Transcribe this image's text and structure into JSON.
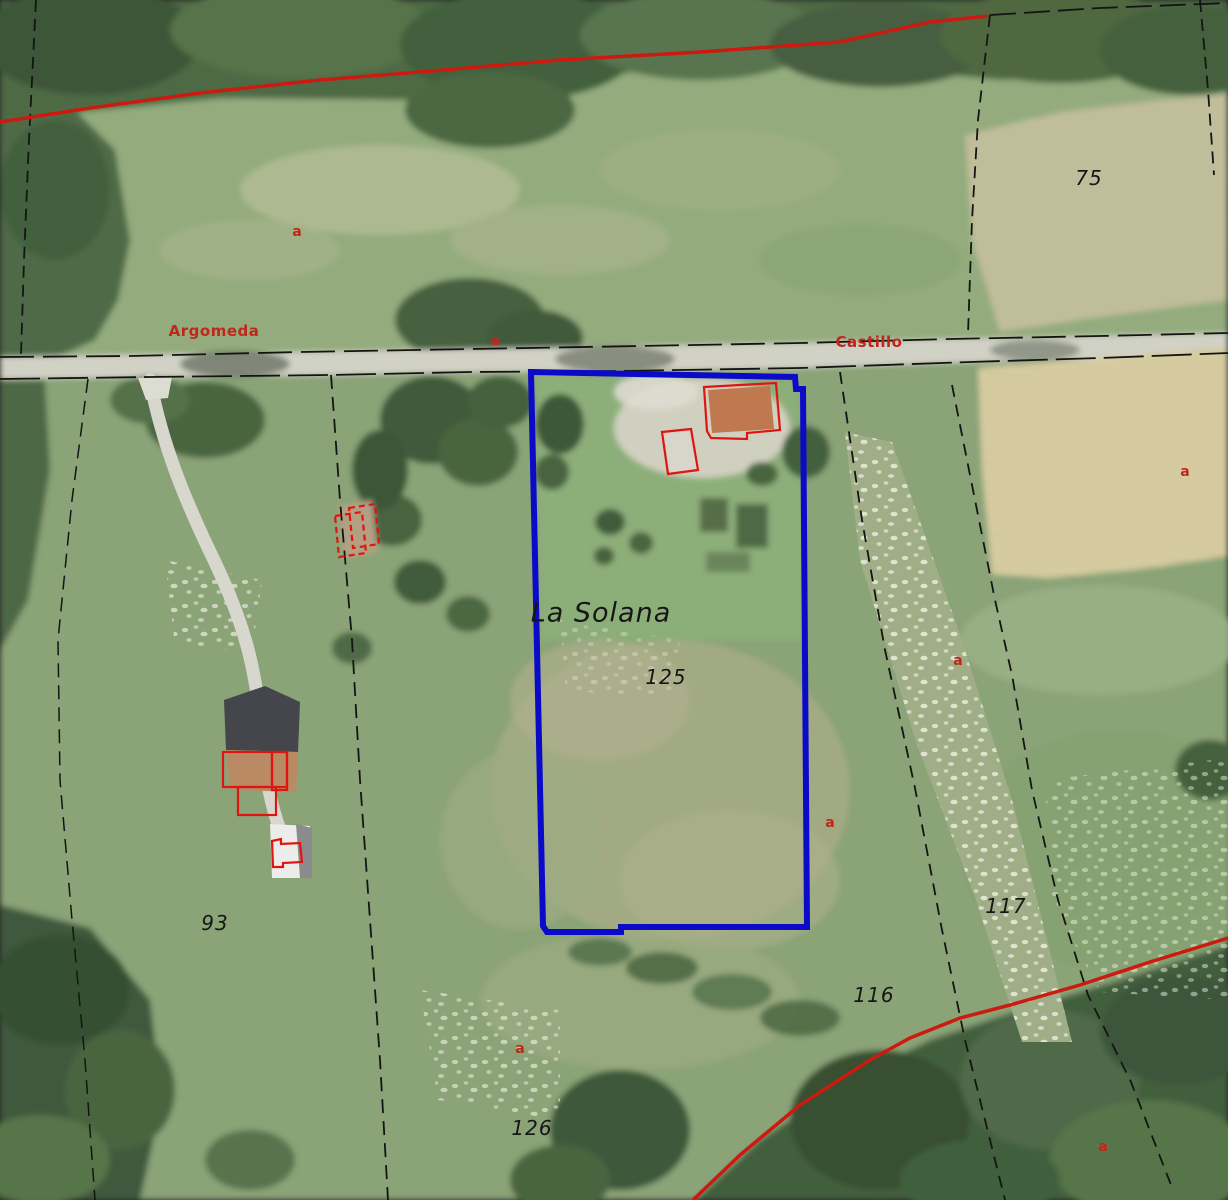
{
  "map": {
    "place_label": "La Solana",
    "street_labels": [
      {
        "text": "Argomeda"
      },
      {
        "text": "Castillo"
      }
    ],
    "parcel_labels": [
      {
        "id": "75"
      },
      {
        "id": "125"
      },
      {
        "id": "93"
      },
      {
        "id": "117"
      },
      {
        "id": "116"
      },
      {
        "id": "126"
      }
    ],
    "zone_markers": [
      {
        "text": "a"
      },
      {
        "text": "a"
      },
      {
        "text": "a"
      },
      {
        "text": "a"
      },
      {
        "text": "a"
      },
      {
        "text": "a"
      },
      {
        "text": "a"
      }
    ],
    "selected_parcel_id": "125",
    "colors": {
      "parcel_blue": "#0a0ac8",
      "boundary_red": "#cc1a10",
      "building_outline_red": "#e01410",
      "cadastral_black": "#141414",
      "label_black": "#161616",
      "street_label_red": "#c2251a"
    }
  }
}
